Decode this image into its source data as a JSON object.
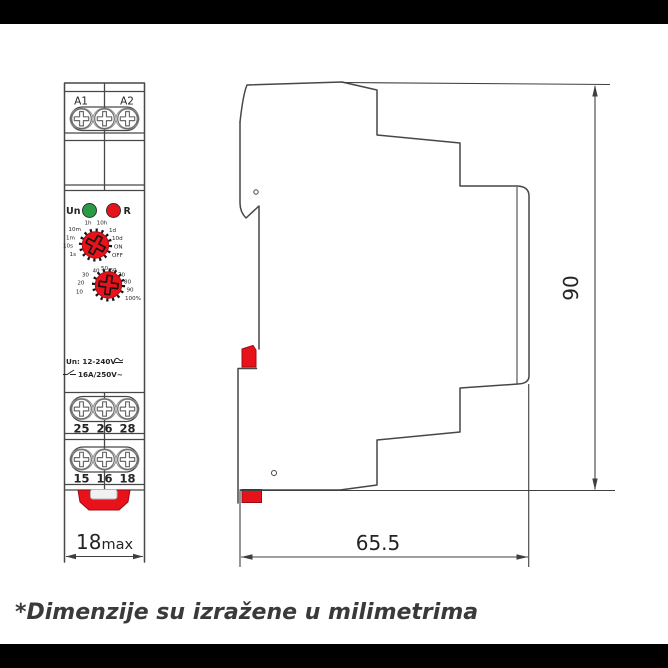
{
  "caption": "*Dimenzije su izražene u milimetrima",
  "colors": {
    "red": "#e8121b",
    "green": "#289b44",
    "line": "#474747",
    "text": "#242424"
  },
  "front": {
    "power_terminals": {
      "labels": [
        "A1",
        "A2"
      ]
    },
    "leds": {
      "un_label": "Un",
      "r_label": "R"
    },
    "time_dial": {
      "labels": [
        "1h",
        "10h",
        "10m",
        "1d",
        "1m",
        "10d",
        "10s",
        "ON",
        "1s",
        "OFF"
      ]
    },
    "percent_dial": {
      "labels": [
        "40",
        "50",
        "60",
        "30",
        "70",
        "20",
        "80",
        "10",
        "90",
        "100%"
      ]
    },
    "ratings": {
      "line1": "Un: 12-240V",
      "line2": "16A/250V~"
    },
    "output_terminals_row1": {
      "labels": [
        "25",
        "26",
        "28"
      ]
    },
    "output_terminals_row2": {
      "labels": [
        "15",
        "16",
        "18"
      ]
    },
    "width_dimension": {
      "value": "18",
      "suffix": "max"
    }
  },
  "side": {
    "height_dimension": "90",
    "depth_dimension": "65.5"
  }
}
